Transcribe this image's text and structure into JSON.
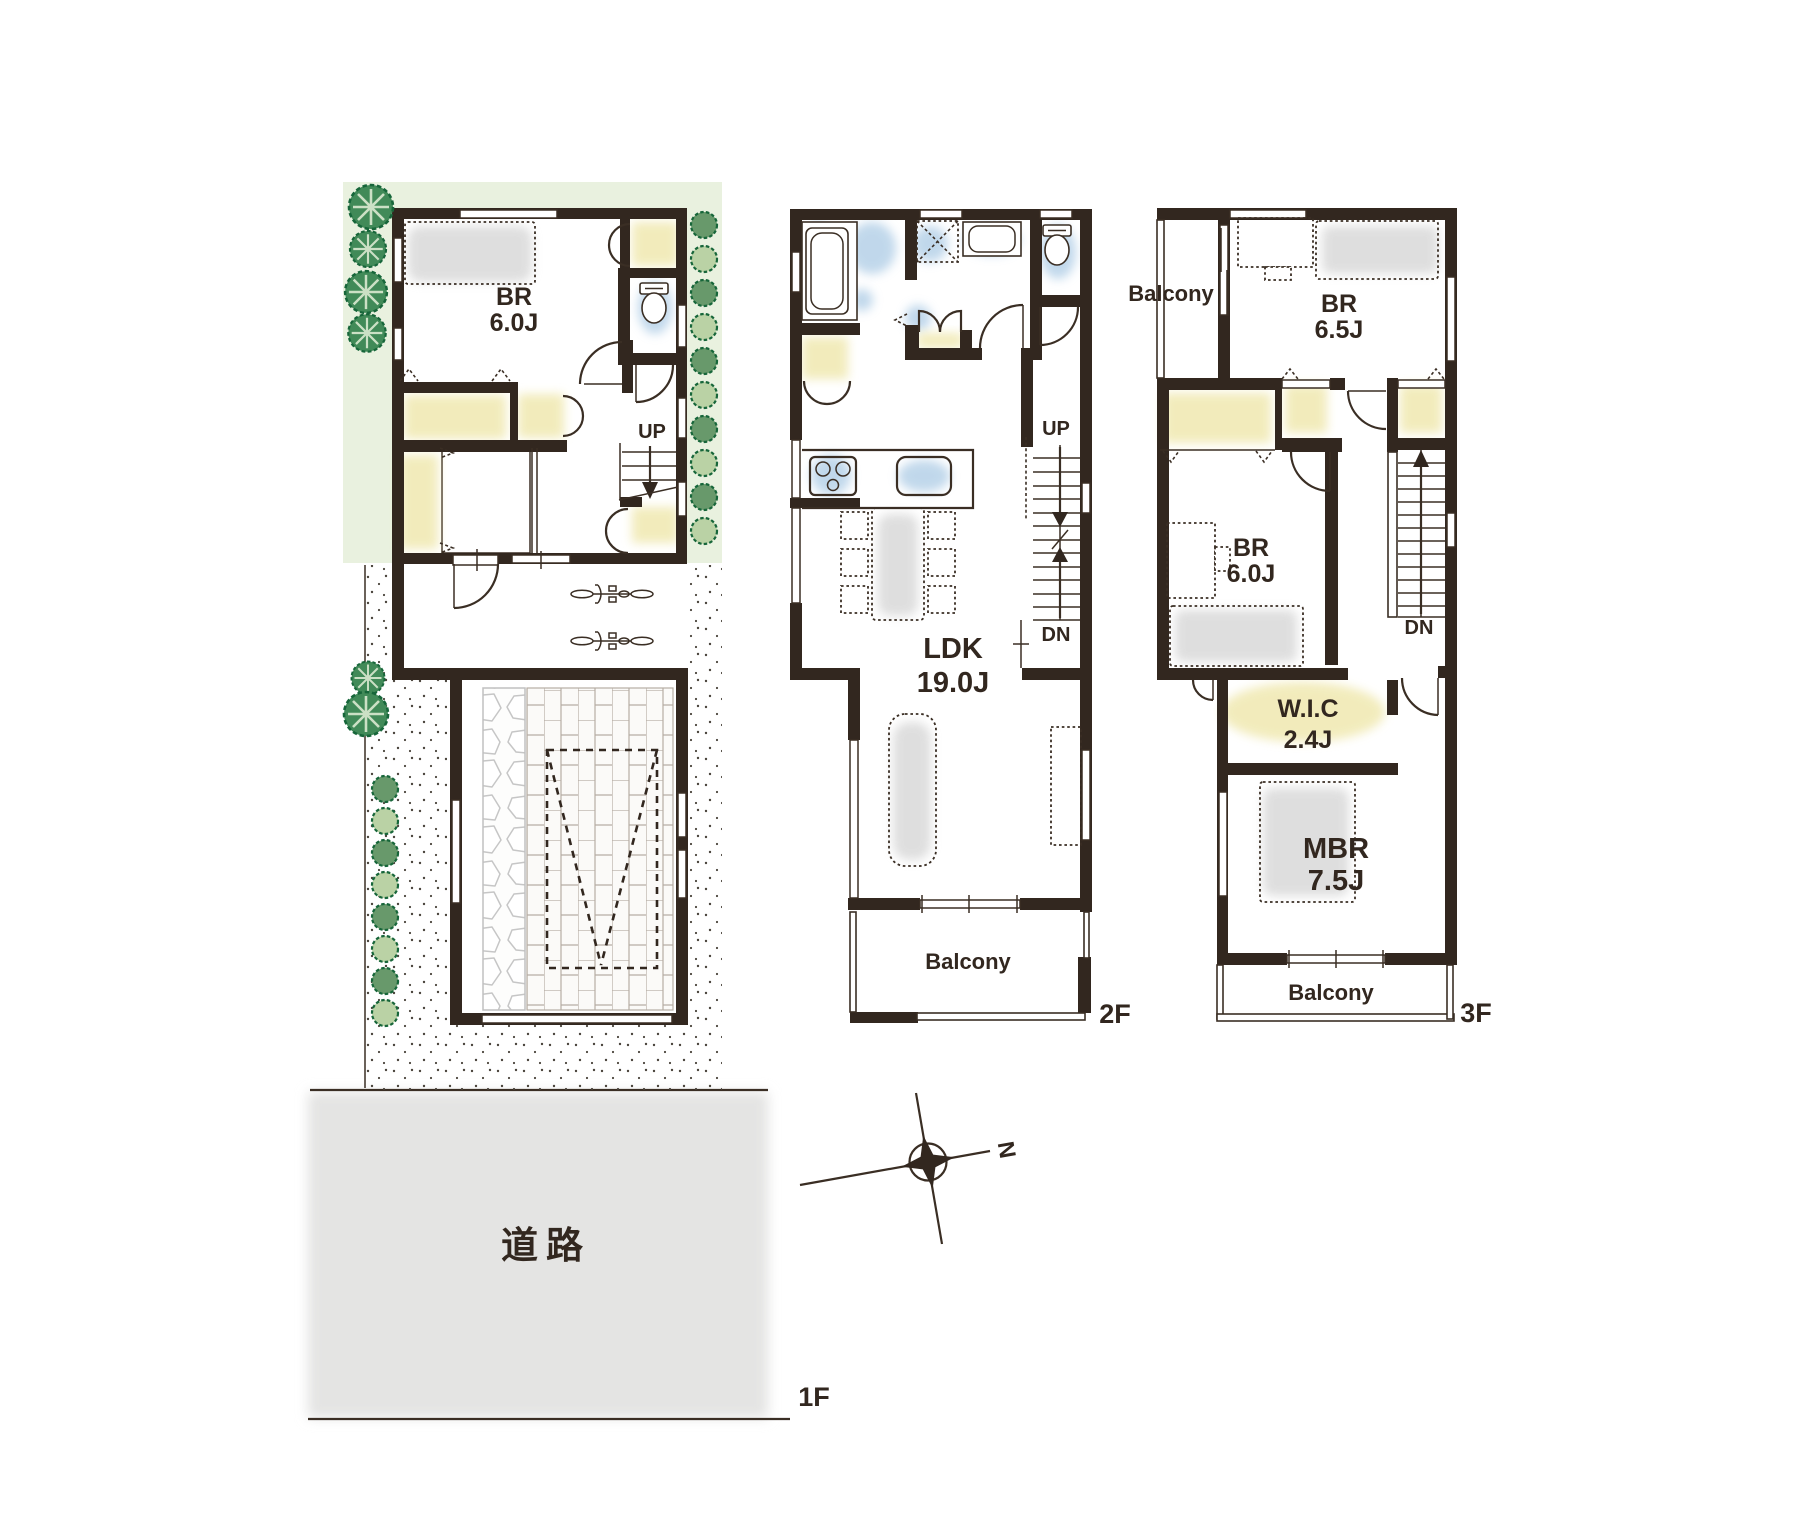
{
  "colors": {
    "wall": "#32271f",
    "line": "#3a2e24",
    "garden": "#e9f1df",
    "tree": "#418a58",
    "bush-dark": "#68996b",
    "bush-light": "#bad2a5",
    "blue": "#a9c9e4",
    "yellow": "#efe7ab",
    "gray": "#d9d9d9",
    "road": "#e4e4e3"
  },
  "floor1": {
    "tag": "1F",
    "bedroom": {
      "name": "BR",
      "size": "6.0J"
    },
    "stairs_up": "UP",
    "road_label": "道路"
  },
  "floor2": {
    "tag": "2F",
    "ldk": {
      "name": "LDK",
      "size": "19.0J"
    },
    "stairs_up": "UP",
    "stairs_down": "DN",
    "balcony": "Balcony"
  },
  "floor3": {
    "tag": "3F",
    "balcony_side": "Balcony",
    "bedroom_a": {
      "name": "BR",
      "size": "6.5J"
    },
    "bedroom_b": {
      "name": "BR",
      "size": "6.0J"
    },
    "stairs_down": "DN",
    "wic": {
      "name": "W.I.C",
      "size": "2.4J"
    },
    "master_bedroom": {
      "name": "MBR",
      "size": "7.5J"
    },
    "balcony_bottom": "Balcony"
  },
  "compass": {
    "north": "N"
  }
}
